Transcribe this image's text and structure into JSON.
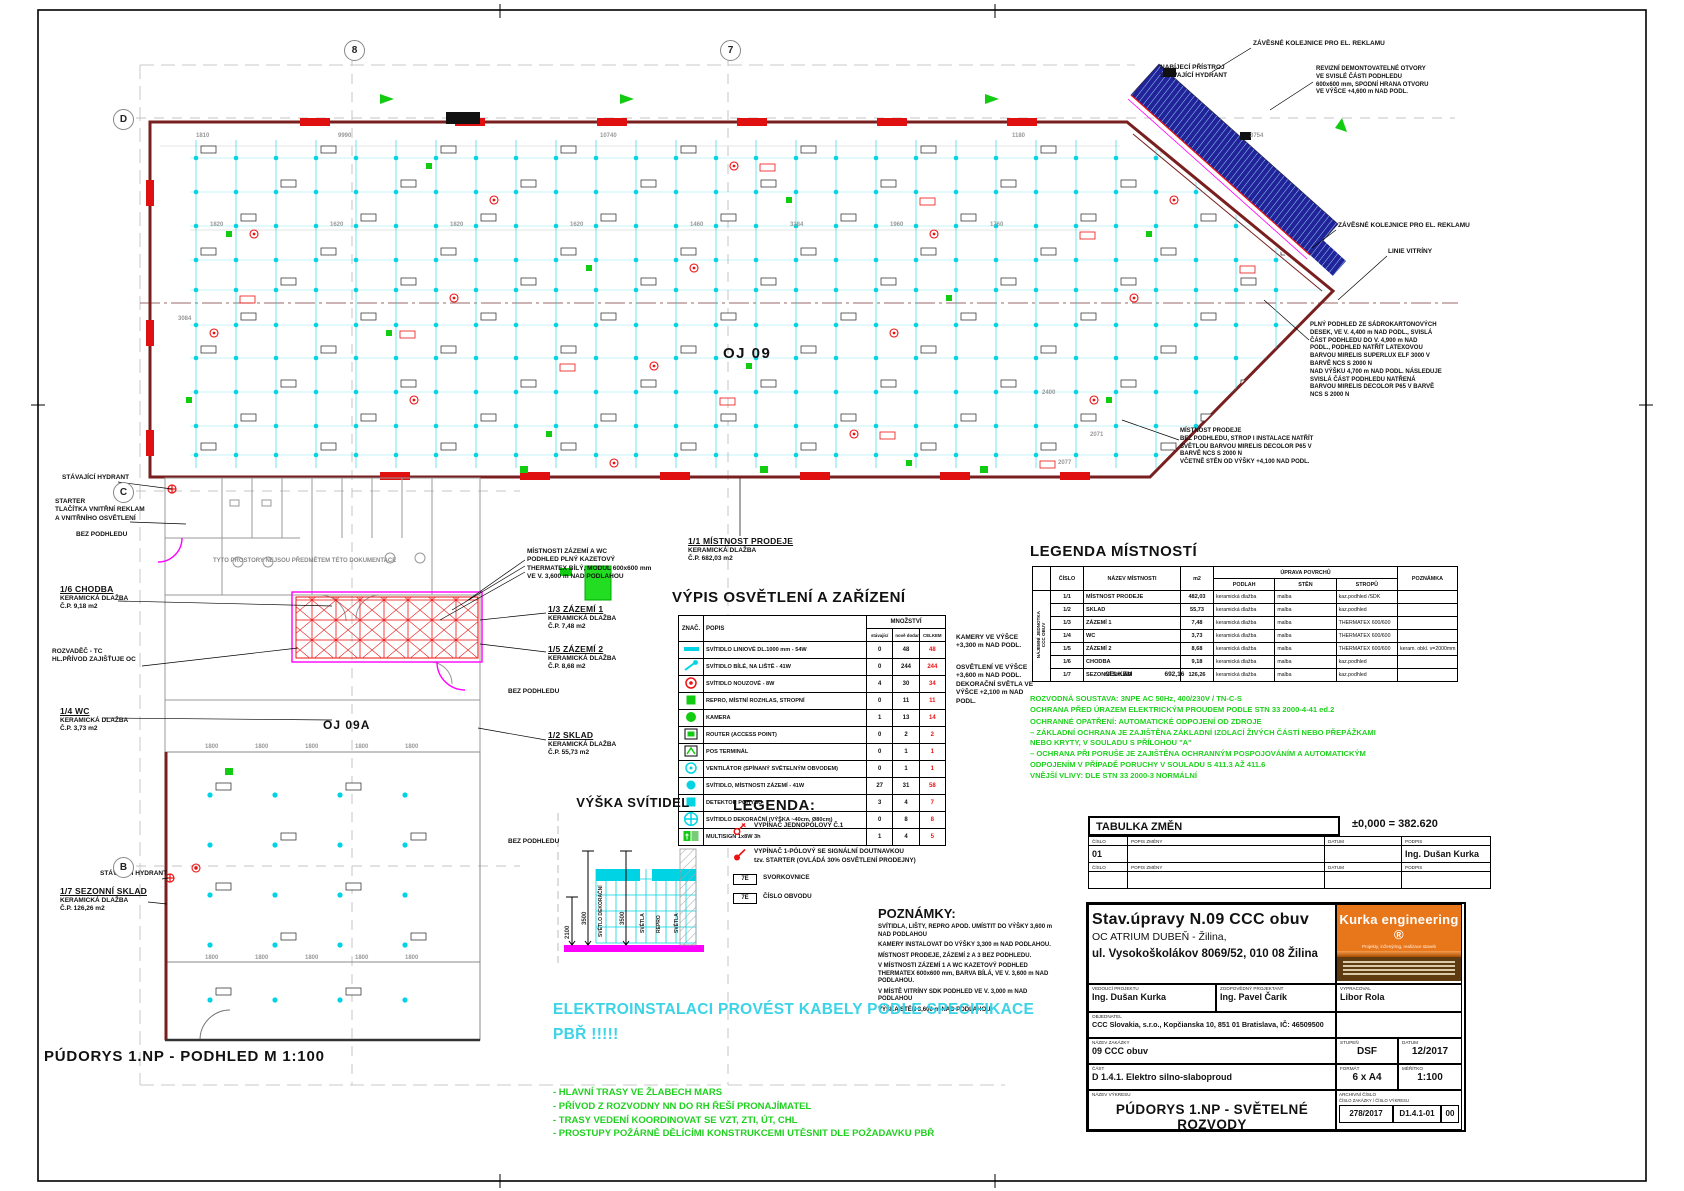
{
  "sheet": {
    "bottom_title": "PÚDORYS 1.NP - PODHLED   M 1:100"
  },
  "grid": {
    "cols": [
      "8",
      "7"
    ],
    "rows": [
      "D",
      "C",
      "B"
    ]
  },
  "plan": {
    "labels": [
      {
        "body": "STÁVAJÍCÍ HYDRANT",
        "x": 62,
        "y": 474
      },
      {
        "body": "STARTER\nTLAČÍTKA VNITŘNÍ REKLAM\nA VNITŘNÍHO OSVĚTLENÍ",
        "x": 55,
        "y": 498
      },
      {
        "body": "BEZ PODHLEDU",
        "x": 76,
        "y": 531
      },
      {
        "head": "1/6 CHODBA",
        "body": "KERAMICKÁ DLAŽBA\nČ.P.  9,18 m2",
        "x": 60,
        "y": 584
      },
      {
        "body": "ROZVADĚČ - TC\nHL.PŘÍVOD ZAJIŠŤUJE OC",
        "x": 52,
        "y": 648
      },
      {
        "head": "1/4 WC",
        "body": "KERAMICKÁ DLAŽBA\nČ.P.  3,73 m2",
        "x": 60,
        "y": 706
      },
      {
        "head": "1/7 SEZONNÍ SKLAD",
        "body": "KERAMICKÁ DLAŽBA\nČ.P.  126,26 m2",
        "x": 60,
        "y": 886
      },
      {
        "body": "STÁVAJÍCÍ HYDRANT",
        "x": 100,
        "y": 870
      },
      {
        "body": "TYTO PROSTORY NEJSOU PŘEDMĚTEM TÉTO DOKUMENTACE",
        "x": 213,
        "y": 558,
        "cls": "gray"
      },
      {
        "body": "MÍSTNOSTI ZÁZEMÍ A WC\nPODHLED PLNÝ KAZETOVÝ\nTHERMATEX BÍLÝ, MODUL 600x600 mm\nVE V. 3,600 m NAD PODLAHOU",
        "x": 527,
        "y": 548
      },
      {
        "head": "1/1 MÍSTNOST PRODEJE",
        "body": "KERAMICKÁ DLAŽBA\nČ.P.  682,03 m2",
        "x": 688,
        "y": 536
      },
      {
        "head": "1/3 ZÁZEMÍ 1",
        "body": "KERAMICKÁ DLAŽBA\nČ.P.  7,48 m2",
        "x": 548,
        "y": 604
      },
      {
        "head": "1/5 ZÁZEMÍ 2",
        "body": "KERAMICKÁ DLAŽBA\nČ.P.  8,68 m2",
        "x": 548,
        "y": 644
      },
      {
        "body": "BEZ PODHLEDU",
        "x": 508,
        "y": 688
      },
      {
        "head": "1/2 SKLAD",
        "body": "KERAMICKÁ DLAŽBA\nČ.P.  55,73 m2",
        "x": 548,
        "y": 730
      },
      {
        "body": "BEZ PODHLEDU",
        "x": 508,
        "y": 838
      },
      {
        "body": "OJ 09",
        "x": 723,
        "y": 344,
        "cls": "big"
      },
      {
        "body": "OJ 09A",
        "x": 323,
        "y": 718,
        "cls": "big2"
      },
      {
        "body": "ZÁVĚSNÉ KOLEJNICE PRO EL. REKLAMU",
        "x": 1253,
        "y": 40
      },
      {
        "body": "NABÍJECÍ PŘÍSTROJ\nSTÁVAJÍCÍ HYDRANT",
        "x": 1160,
        "y": 64
      },
      {
        "body": "REVIZNÍ DEMONTOVATELNÉ OTVORY\nVE SVISLÉ ČÁSTI PODHLEDU\n600x600 mm, SPODNÍ HRANA OTVORU\nVE VÝŠCE +4,600 m NAD PODL.",
        "x": 1316,
        "y": 66,
        "cls": "note"
      },
      {
        "body": "ZÁVĚSNÉ KOLEJNICE PRO EL. REKLAMU",
        "x": 1338,
        "y": 222
      },
      {
        "body": "LINIE VITRÍNY",
        "x": 1388,
        "y": 248
      },
      {
        "body": "PLNÝ PODHLED ZE SÁDROKARTONOVÝCH\nDESEK, VE V. 4,400 m NAD PODL., SVISLÁ\nČÁST PODHLEDU DO V. 4,900 m NAD\nPODL., PODHLED NATŘÍT LATEXOVOU\nBARVOU MIRELIS SUPERLUX ELF 3000 V\nBARVĚ NCS S 2000 N\nNAD VÝŠKU 4,700 m NAD PODL. NÁSLEDUJE\nSVISLÁ ČÁST PODHLEDU NATŘENÁ\nBARVOU MIRELIS DECOLOR P65 V BARVĚ\nNCS S 2000 N",
        "x": 1310,
        "y": 322,
        "cls": "note"
      },
      {
        "body": "MÍSTNOST PRODEJE\nBEZ PODHLEDU, STROP I INSTALACE NATŘÍT\nSVĚTLOU BARVOU MIRELIS DECOLOR P65 V\nBARVĚ NCS S 2000 N\nVČETNĚ STĚN OD VÝŠKY +4,100 NAD PODL.",
        "x": 1180,
        "y": 428,
        "cls": "note"
      },
      {
        "body": "KAMERY VE VÝŠCE\n+3,300 m NAD PODL.",
        "x": 956,
        "y": 634
      },
      {
        "body": "OSVĚTLENÍ VE VÝŠCE\n+3,600 m NAD PODL.\nDEKORAČNÍ SVĚTLA VE\nVÝŠCE +2,100 m NAD\nPODL.",
        "x": 956,
        "y": 664
      }
    ],
    "dimensions": [
      {
        "t": "1810",
        "x": 196,
        "y": 133
      },
      {
        "t": "9990",
        "x": 338,
        "y": 133
      },
      {
        "t": "10740",
        "x": 600,
        "y": 133
      },
      {
        "t": "1180",
        "x": 1012,
        "y": 133
      },
      {
        "t": "3754",
        "x": 1250,
        "y": 133
      },
      {
        "t": "1820",
        "x": 210,
        "y": 222
      },
      {
        "t": "1620",
        "x": 330,
        "y": 222
      },
      {
        "t": "1820",
        "x": 450,
        "y": 222
      },
      {
        "t": "1620",
        "x": 570,
        "y": 222
      },
      {
        "t": "1460",
        "x": 690,
        "y": 222
      },
      {
        "t": "3384",
        "x": 790,
        "y": 222
      },
      {
        "t": "1960",
        "x": 890,
        "y": 222
      },
      {
        "t": "1760",
        "x": 990,
        "y": 222
      },
      {
        "t": "3084",
        "x": 178,
        "y": 316
      },
      {
        "t": "2400",
        "x": 1042,
        "y": 390
      },
      {
        "t": "2077",
        "x": 1058,
        "y": 460
      },
      {
        "t": "2071",
        "x": 1090,
        "y": 432
      },
      {
        "t": "1800",
        "x": 205,
        "y": 744
      },
      {
        "t": "1800",
        "x": 255,
        "y": 744
      },
      {
        "t": "1800",
        "x": 305,
        "y": 744
      },
      {
        "t": "1800",
        "x": 355,
        "y": 744
      },
      {
        "t": "1800",
        "x": 405,
        "y": 744
      },
      {
        "t": "1800",
        "x": 205,
        "y": 955
      },
      {
        "t": "1800",
        "x": 255,
        "y": 955
      },
      {
        "t": "1800",
        "x": 305,
        "y": 955
      },
      {
        "t": "1800",
        "x": 355,
        "y": 955
      },
      {
        "t": "1800",
        "x": 405,
        "y": 955
      }
    ]
  },
  "fixtures_table": {
    "title": "VÝPIS OSVĚTLENÍ A ZAŘÍZENÍ",
    "col_znak": "ZNAČ.",
    "col_popis": "POPIS",
    "col_qty": "MNOŽSTVÍ",
    "sub_cols": [
      "stávající",
      "nově dodané",
      "CELKEM"
    ],
    "rows": [
      {
        "icon": "linear-light",
        "popis": "SVÍTIDLO LINIOVÉ DL.1000 mm - 54W",
        "q": [
          "0",
          "48",
          "48"
        ]
      },
      {
        "icon": "track-spot",
        "popis": "SVÍTIDLO BÍLÉ, NA LIŠTĚ - 41W",
        "q": [
          "0",
          "244",
          "244"
        ]
      },
      {
        "icon": "emergency-light",
        "popis": "SVÍTIDLO NOUZOVÉ - 8W",
        "q": [
          "4",
          "30",
          "34"
        ]
      },
      {
        "icon": "speaker",
        "popis": "REPRO, MÍSTNÍ ROZHLAS, STROPNÍ",
        "q": [
          "0",
          "11",
          "11"
        ]
      },
      {
        "icon": "camera",
        "popis": "KAMERA",
        "q": [
          "1",
          "13",
          "14"
        ]
      },
      {
        "icon": "router",
        "popis": "ROUTER (ACCESS POINT)",
        "q": [
          "0",
          "2",
          "2"
        ]
      },
      {
        "icon": "pos-terminal",
        "popis": "POS TERMINÁL",
        "q": [
          "0",
          "1",
          "1"
        ]
      },
      {
        "icon": "fan",
        "popis": "VENTILÁTOR (SPÍNANÝ SVĚTELNÝM OBVODEM)",
        "q": [
          "0",
          "1",
          "1"
        ]
      },
      {
        "icon": "ceiling-light",
        "popis": "SVÍTIDLO, MÍSTNOSTI ZÁZEMÍ - 41W",
        "q": [
          "27",
          "31",
          "58"
        ]
      },
      {
        "icon": "motion-detector",
        "popis": "DETEKTOR POHYBU",
        "q": [
          "3",
          "4",
          "7"
        ]
      },
      {
        "icon": "decorative-light",
        "popis": "SVÍTIDLO DEKORAČNÍ (VÝŠKA ~40cm, Ø80cm)",
        "q": [
          "0",
          "8",
          "8"
        ]
      },
      {
        "icon": "exit-light",
        "popis": "MULTISIGN 1x8W 3h",
        "q": [
          "1",
          "4",
          "5"
        ]
      }
    ]
  },
  "rooms_table": {
    "title": "LEGENDA MÍSTNOSTÍ",
    "vertical_label": "NÁJEMNÍ JEDNOTKA\nCCC OBUV",
    "headers": {
      "cislo": "ČÍSLO",
      "nazev": "NÁZEV MÍSTNOSTI",
      "m2": "m2",
      "uprava": "ÚPRAVA POVRCHŮ",
      "podlah": "PODLAH",
      "sten": "STĚN",
      "stropu": "STROPŮ",
      "poznamka": "POZNÁMKA"
    },
    "rows": [
      [
        "1/1",
        "MÍSTNOST PRODEJE",
        "482,03",
        "keramická dlažba",
        "malba",
        "kaz.podhled /SDK",
        ""
      ],
      [
        "1/2",
        "SKLAD",
        "55,73",
        "keramická dlažba",
        "malba",
        "kaz.podhled",
        ""
      ],
      [
        "1/3",
        "ZÁZEMÍ 1",
        "7,48",
        "keramická dlažba",
        "malba",
        "THERMATEX 600/600",
        ""
      ],
      [
        "1/4",
        "WC",
        "3,73",
        "keramická dlažba",
        "malba",
        "THERMATEX 600/600",
        ""
      ],
      [
        "1/5",
        "ZÁZEMÍ 2",
        "8,68",
        "keramická dlažba",
        "malba",
        "THERMATEX 600/600",
        "keram. obkl. v=2000mm"
      ],
      [
        "1/6",
        "CHODBA",
        "9,18",
        "keramická dlažba",
        "malba",
        "kaz.podhled",
        ""
      ],
      [
        "1/7",
        "SEZONNÍ SKLAD",
        "126,26",
        "keramická dlažba",
        "malba",
        "kaz.podhled",
        ""
      ]
    ],
    "total_label": "CELKEM",
    "total": "692,16"
  },
  "electrical_notes": [
    "ROZVODNÁ SOUSTAVA:  3NPE AC 50Hz, 400/230V / TN-C-S",
    "OCHRANA PŘED ÚRAZEM ELEKTRICKÝM PROUDEM PODLE STN 33 2000-4-41 ed.2",
    "OCHRANNÉ OPATŘENÍ: AUTOMATICKÉ ODPOJENÍ OD ZDROJE",
    "–  ZÁKLADNÍ OCHRANA JE ZAJIŠTĚNA ZÁKLADNÍ IZOLACÍ ŽIVÝCH ČÁSTÍ NEBO PŘEPÁŽKAMI\n    NEBO KRYTY, V SOULADU S PŘÍLOHOU \"A\"",
    "–  OCHRANA PŘI PORUŠE JE ZAJIŠTĚNA OCHRANNÝM POSPOJOVÁNÍM A AUTOMATICKÝM\n    ODPOJENÍM V PŘÍPADĚ PORUCHY V SOULADU S 411.3 AŽ 411.6",
    "VNĚJŠÍ VLIVY: DLE STN 33 2000-3   NORMÁLNÍ"
  ],
  "legend": {
    "title": "LEGENDA:",
    "items": [
      {
        "icon": "switch-single",
        "text": "VYPÍNAČ JEDNOPÓLOVÝ Č.1"
      },
      {
        "icon": "switch-starter",
        "text": "VYPÍNAČ 1-PÓLOVÝ SE SIGNÁLNÍ DOUTNAVKOU\ntzv. STARTER (OVLÁDÁ 30% OSVĚTLENÍ PRODEJNY)"
      },
      {
        "icon": "code-box",
        "code": "7E",
        "text": "SVORKOVNICE"
      },
      {
        "icon": "code-box",
        "code": "7E",
        "text": "ČÍSLO OBVODU"
      }
    ]
  },
  "poznamky": {
    "title": "POZNÁMKY:",
    "lines": [
      "SVÍTIDLA, LIŠTY, REPRO APOD. UMÍSTIT DO VÝŠKY 3,600 m NAD PODLAHOU",
      "KAMERY INSTALOVAT DO VÝŠKY 3,300 m NAD PODLAHOU.",
      "MÍSTNOST PRODEJE, ZÁZEMÍ 2 A 3 BEZ PODHLEDU.",
      "V MÍSTNOSTI ZÁZEMÍ 1 A WC KAZETOVÝ PODHLED THERMATEX 600x600 mm, BARVA BÍLÁ, VE V. 3,600 m NAD PODLAHOU.",
      "V MÍSTĚ VITRÍNY SDK PODHLED VE V. 3,000 m NAD PODLAHOU",
      "VÝŠKA STĚN 3,600 m NAD PODLAHOU"
    ]
  },
  "vyska": {
    "title": "VÝŠKA SVÍTIDEL",
    "dims": [
      "3500",
      "3500",
      "2100"
    ],
    "labels": [
      "SVĚTLO DEKORAČNÍ",
      "SVĚTLA",
      "REPRO",
      "SVĚTLA"
    ]
  },
  "cable_warning": "ELEKTROINSTALACI PROVÉST KABELY PODLE SPECIFIKACE\nPBŘ !!!!!",
  "site_notes": [
    "- HLAVNÍ TRASY VE ŽLABECH MARS",
    "- PŘÍVOD Z ROZVODNY NN DO RH ŘEŠÍ PRONAJÍMATEL",
    "- TRASY VEDENÍ KOORDINOVAT SE VZT, ZTI, ÚT, CHL",
    "- PROSTUPY POŽÁRNĚ DĚLÍCÍMI KONSTRUKCEMI  UTĚSNIT DLE POŽADAVKU PBŘ"
  ],
  "tabulka_zmen": {
    "title": "TABULKA ZMĚN",
    "level": "±0,000 = 382.620",
    "cols": [
      "ČÍSLO",
      "POPIS ZMĚNY",
      "DATUM",
      "PODPIS"
    ],
    "row1_cislo": "01",
    "row1_podpis": "Ing. Dušan Kurka"
  },
  "title_block": {
    "project_title": "Stav.úpravy N.09 CCC obuv",
    "project_sub": "OC ATRIUM DUBEŇ - Žilina,",
    "project_addr": "ul. Vysokoškolákov 8069/52, 010 08 Žilina",
    "drawing_title": "PÚDORYS 1.NP - SVĚTELNÉ ROZVODY",
    "fields": {
      "vedouci": {
        "label": "VEDOUCÍ PROJEKTU",
        "value": "Ing. Dušan Kurka"
      },
      "zodp": {
        "label": "ZODPOVĚDNÝ PROJEKTANT",
        "value": "Ing. Pavel Čarík"
      },
      "vypracoval": {
        "label": "VYPRACOVAL",
        "value": "Libor Rola"
      },
      "objednatel": {
        "label": "OBJEDNATEL",
        "value": "CCC Slovakia, s.r.o., Kopčianska 10, 851 01 Bratislava, IČ: 46509500"
      },
      "zakazka": {
        "label": "NÁZEV ZAKÁZKY",
        "value": "09  CCC obuv"
      },
      "cast": {
        "label": "ČÁST",
        "value": "D 1.4.1. Elektro silno-slaboproud"
      },
      "nazev_vykresu_label": "NÁZEV VÝKRESU",
      "stupen": {
        "label": "STUPEŇ",
        "value": "DSF"
      },
      "datum": {
        "label": "DATUM",
        "value": "12/2017"
      },
      "format": {
        "label": "FORMÁT",
        "value": "6 x A4"
      },
      "meritko": {
        "label": "MĚŘÍTKO",
        "value": "1:100"
      },
      "archiv": {
        "label": "ARCHIVNÍ ČÍSLO",
        "label2": "ČÍSLO ZAKÁZKY",
        "value": "278/2017"
      },
      "cislo_vykresu": {
        "label": "ČÍSLO VÝKRESU",
        "value": "D1.4.1-01"
      },
      "revize": "00"
    }
  },
  "logo": {
    "name": "Kurka engineering",
    "reg": "®",
    "tagline": "Projekty, inženýring, realizace staveb"
  }
}
